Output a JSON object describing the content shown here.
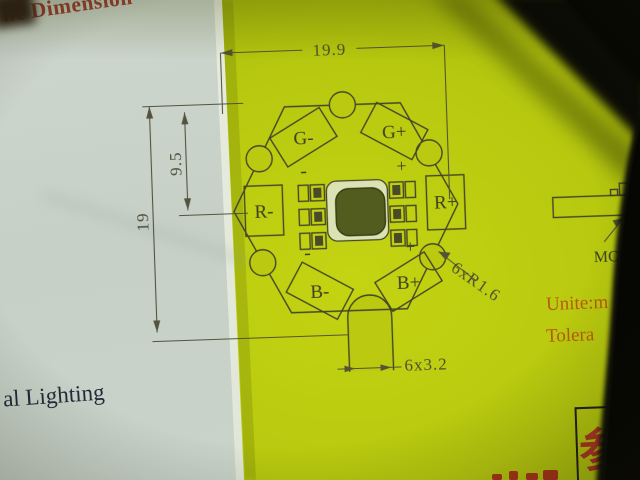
{
  "texts": {
    "title_fragment": "ne Dimension",
    "bottom_left_fragment": "al Lighting",
    "unit_label": "Unite:m",
    "tolerance_label": "Tolera",
    "mcpcb_label": "MCP",
    "stamp_character": "参"
  },
  "drawing": {
    "dimensions": {
      "width": "19.9",
      "height": "19",
      "half_height": "9.5",
      "notch": "6xR1.6",
      "tab": "6x3.2"
    },
    "pads": [
      {
        "label": "G-"
      },
      {
        "label": "G+"
      },
      {
        "label": "R-"
      },
      {
        "label": "R+"
      },
      {
        "label": "B-"
      },
      {
        "label": "B+"
      }
    ],
    "polarity_marks": [
      {
        "symbol": "-"
      },
      {
        "symbol": "+"
      },
      {
        "symbol": "-"
      },
      {
        "symbol": "+"
      }
    ]
  },
  "colors": {
    "paper_yellow": "#b8c90f",
    "paper_white": "#c9d2c9",
    "ink": "#3a3a26",
    "title_red": "#9c3a32",
    "accent_orange": "#b65d10",
    "stamp_red": "#aa3522",
    "cable_black": "#0a0a06"
  }
}
